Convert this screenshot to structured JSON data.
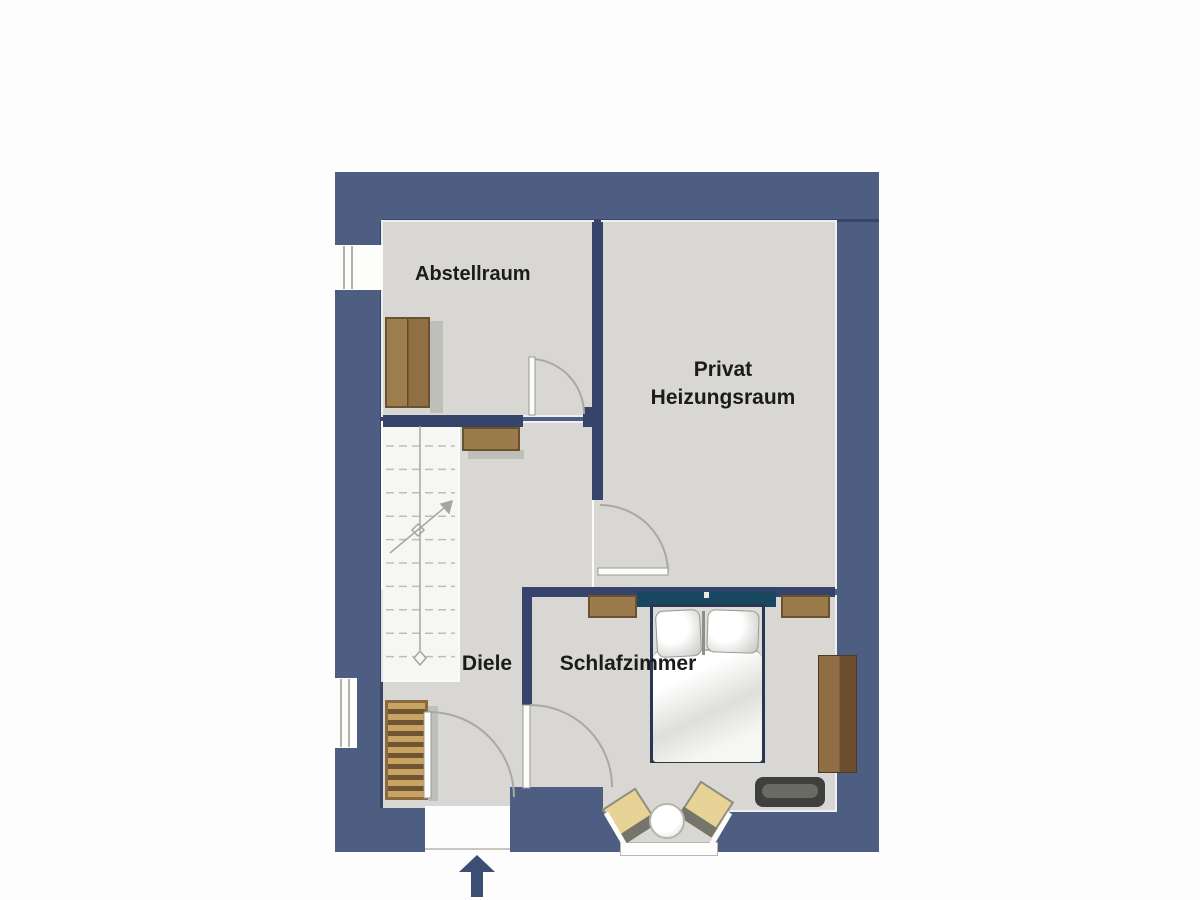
{
  "rooms": {
    "abstellraum": {
      "label": "Abstellraum"
    },
    "heizungsraum": {
      "label_line1": "Privat",
      "label_line2": "Heizungsraum"
    },
    "diele": {
      "label": "Diele"
    },
    "schlafzimmer": {
      "label": "Schlafzimmer"
    }
  },
  "entrance": {
    "icon": "arrow-up-icon",
    "direction": "up"
  },
  "colors": {
    "wall": "#4d5e82",
    "wallEdge": "#394564",
    "innerWall": "#36436a",
    "floor": "#d8d7d3",
    "stairFloor": "#f6f6f4",
    "wood": "#9b7a4c",
    "woodDark": "#6a522f",
    "headboard": "#17485f",
    "bedFrame": "#2b3752",
    "chair": "#e6d395",
    "dresser": "#3f3f3d",
    "arrow": "#3d4e74",
    "doorLine": "#aaa9a1",
    "text": "#1b1b1b"
  },
  "stairs": {
    "step_count": 10
  }
}
